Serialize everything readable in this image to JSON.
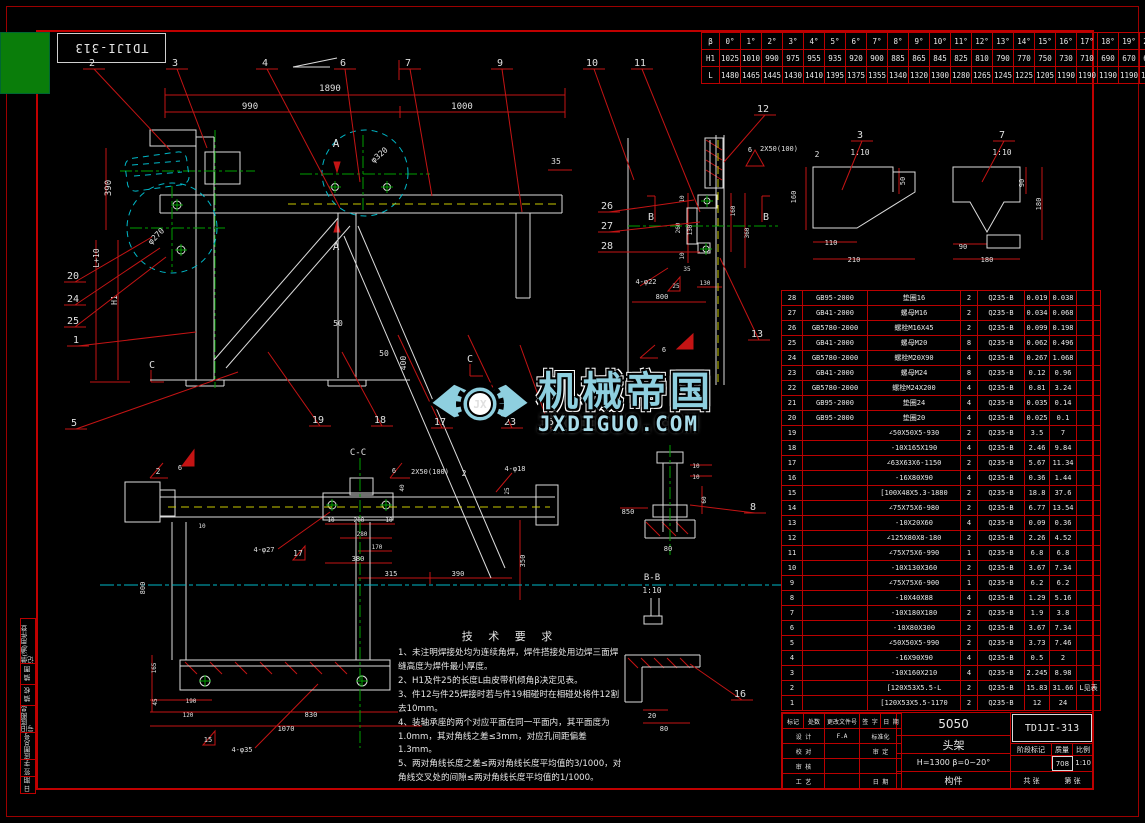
{
  "corner_drawing_no": "TD1JI-313",
  "angle_table": {
    "row_labels": [
      "β",
      "H1",
      "L"
    ],
    "rows": [
      [
        "0°",
        "1°",
        "2°",
        "3°",
        "4°",
        "5°",
        "6°",
        "7°",
        "8°",
        "9°",
        "10°",
        "11°",
        "12°",
        "13°",
        "14°",
        "15°",
        "16°",
        "17°",
        "18°",
        "19°",
        "20°"
      ],
      [
        "1025",
        "1010",
        "990",
        "975",
        "955",
        "935",
        "920",
        "900",
        "885",
        "865",
        "845",
        "825",
        "810",
        "790",
        "770",
        "750",
        "730",
        "710",
        "690",
        "670",
        "645"
      ],
      [
        "1480",
        "1465",
        "1445",
        "1430",
        "1410",
        "1395",
        "1375",
        "1355",
        "1340",
        "1320",
        "1300",
        "1280",
        "1265",
        "1245",
        "1225",
        "1205",
        "1190",
        "1190",
        "1190",
        "1190",
        "1190"
      ]
    ]
  },
  "parts_list": {
    "rows": [
      [
        "28",
        "GB95-2000",
        "垫圈16",
        "2",
        "Q235-B",
        "0.019",
        "0.038",
        ""
      ],
      [
        "27",
        "GB41-2000",
        "螺母M16",
        "2",
        "Q235-B",
        "0.034",
        "0.068",
        ""
      ],
      [
        "26",
        "GB5780-2000",
        "螺栓M16X45",
        "2",
        "Q235-B",
        "0.099",
        "0.198",
        ""
      ],
      [
        "25",
        "GB41-2000",
        "螺母M20",
        "8",
        "Q235-B",
        "0.062",
        "0.496",
        ""
      ],
      [
        "24",
        "GB5780-2000",
        "螺栓M20X90",
        "4",
        "Q235-B",
        "0.267",
        "1.068",
        ""
      ],
      [
        "23",
        "GB41-2000",
        "螺母M24",
        "8",
        "Q235-B",
        "0.12",
        "0.96",
        ""
      ],
      [
        "22",
        "GB5780-2000",
        "螺栓M24X200",
        "4",
        "Q235-B",
        "0.81",
        "3.24",
        ""
      ],
      [
        "21",
        "GB95-2000",
        "垫圈24",
        "4",
        "Q235-B",
        "0.035",
        "0.14",
        ""
      ],
      [
        "20",
        "GB95-2000",
        "垫圈20",
        "4",
        "Q235-B",
        "0.025",
        "0.1",
        ""
      ],
      [
        "19",
        "",
        "∠50X50X5-930",
        "2",
        "Q235-B",
        "3.5",
        "7",
        ""
      ],
      [
        "18",
        "",
        "-10X165X190",
        "4",
        "Q235-B",
        "2.46",
        "9.84",
        ""
      ],
      [
        "17",
        "",
        "∠63X63X6-1150",
        "2",
        "Q235-B",
        "5.67",
        "11.34",
        ""
      ],
      [
        "16",
        "",
        "-16X80X90",
        "4",
        "Q235-B",
        "0.36",
        "1.44",
        ""
      ],
      [
        "15",
        "",
        "[100X48X5.3-1880",
        "2",
        "Q235-B",
        "18.8",
        "37.6",
        ""
      ],
      [
        "14",
        "",
        "∠75X75X6-980",
        "2",
        "Q235-B",
        "6.77",
        "13.54",
        ""
      ],
      [
        "13",
        "",
        "-10X20X60",
        "4",
        "Q235-B",
        "0.09",
        "0.36",
        ""
      ],
      [
        "12",
        "",
        "∠125X80X8-180",
        "2",
        "Q235-B",
        "2.26",
        "4.52",
        ""
      ],
      [
        "11",
        "",
        "∠75X75X6-990",
        "1",
        "Q235-B",
        "6.8",
        "6.8",
        ""
      ],
      [
        "10",
        "",
        "-10X130X360",
        "2",
        "Q235-B",
        "3.67",
        "7.34",
        ""
      ],
      [
        "9",
        "",
        "∠75X75X6-900",
        "1",
        "Q235-B",
        "6.2",
        "6.2",
        ""
      ],
      [
        "8",
        "",
        "-10X40X88",
        "4",
        "Q235-B",
        "1.29",
        "5.16",
        ""
      ],
      [
        "7",
        "",
        "-10X180X180",
        "2",
        "Q235-B",
        "1.9",
        "3.8",
        ""
      ],
      [
        "6",
        "",
        "-10X80X300",
        "2",
        "Q235-B",
        "3.67",
        "7.34",
        ""
      ],
      [
        "5",
        "",
        "∠50X50X5-990",
        "2",
        "Q235-B",
        "3.73",
        "7.46",
        ""
      ],
      [
        "4",
        "",
        "-16X90X90",
        "4",
        "Q235-B",
        "0.5",
        "2",
        ""
      ],
      [
        "3",
        "",
        "-10X160X210",
        "4",
        "Q235-B",
        "2.245",
        "8.98",
        ""
      ],
      [
        "2",
        "",
        "[120X53X5.5-L",
        "2",
        "Q235-B",
        "15.83",
        "31.66",
        "L见表"
      ],
      [
        "1",
        "",
        "[120X53X5.5-1170",
        "2",
        "Q235-B",
        "12",
        "24",
        ""
      ]
    ]
  },
  "title_block": {
    "project": "5050",
    "name": "头架",
    "spec": "H=1300  β=0~20°",
    "type_label": "构件",
    "drawing_no": "TD1JI-313",
    "rev_header": [
      "标记",
      "处数",
      "更改文件号",
      "签 字",
      "日 期"
    ],
    "sign_rows": [
      [
        "设 计",
        "F.A",
        "标准化"
      ],
      [
        "校 对",
        "",
        "审 定"
      ],
      [
        "审 核",
        "",
        ""
      ],
      [
        "工 艺",
        "",
        "日 期"
      ]
    ],
    "stage_headers": [
      "阶段标记",
      "质量",
      "比例"
    ],
    "mass": "708",
    "scale": "1:10",
    "sheet_left": "共  张",
    "sheet_right": "第  张"
  },
  "border_fields": [
    "借(通)用件登记",
    "描 图",
    "描 校",
    "旧底图总号",
    "底图总号",
    "签 字",
    "日 期"
  ],
  "tech_req": {
    "title": "技 术 要 求",
    "lines": [
      "1、未注明焊接处均为连续角焊，焊件搭接处用边焊三面焊缝高度为焊件最小厚度。",
      "2、H1及件25的长度L由皮带机倾角β决定见表。",
      "3、件12与件25焊接时若与件19相碰时在相碰处将件12割去10mm。",
      "4、装轴承座的两个对应平面在同一平面内，其平面度为1.0mm，其对角线之差≤3mm，对应孔间距偏差1.3mm。",
      "5、两对角线长度之差≤两对角线长度平均值的3/1000，对角线交叉处的间隙≤两对角线长度平均值的1/1000。"
    ]
  },
  "watermark": {
    "brand": "机械帝国",
    "site": "JXDIGUO.COM",
    "monogram": "JX"
  },
  "drawing": {
    "labels": [
      {
        "t": "1890",
        "x": 330,
        "y": 91
      },
      {
        "t": "990",
        "x": 250,
        "y": 109
      },
      {
        "t": "1000",
        "x": 462,
        "y": 109
      },
      {
        "t": "35",
        "x": 556,
        "y": 164,
        "s": 8
      },
      {
        "t": "390",
        "x": 111,
        "y": 188,
        "r": -90
      },
      {
        "t": "L+10",
        "x": 99,
        "y": 258,
        "r": -90,
        "s": 8
      },
      {
        "t": "H1",
        "x": 117,
        "y": 300,
        "r": -90,
        "s": 8
      },
      {
        "t": "A",
        "x": 336,
        "y": 147,
        "s": 11
      },
      {
        "t": "A",
        "x": 336,
        "y": 250,
        "s": 11
      },
      {
        "t": "φ320",
        "x": 381,
        "y": 157,
        "r": -40,
        "s": 8
      },
      {
        "t": "φ270",
        "x": 158,
        "y": 238,
        "r": -45,
        "s": 8
      },
      {
        "t": "50",
        "x": 338,
        "y": 326,
        "s": 8
      },
      {
        "t": "50",
        "x": 384,
        "y": 356,
        "s": 8
      },
      {
        "t": "400",
        "x": 406,
        "y": 363,
        "r": -90,
        "s": 8
      },
      {
        "t": "C",
        "x": 152,
        "y": 368,
        "s": 10
      },
      {
        "t": "C",
        "x": 470,
        "y": 362,
        "s": 10
      },
      {
        "t": "B",
        "x": 651,
        "y": 220,
        "s": 10
      },
      {
        "t": "B",
        "x": 766,
        "y": 220,
        "s": 10
      },
      {
        "t": "2X50(100)",
        "x": 779,
        "y": 151,
        "s": 7
      },
      {
        "t": "6",
        "x": 750,
        "y": 152,
        "s": 7
      },
      {
        "t": "2",
        "x": 817,
        "y": 157,
        "s": 8
      },
      {
        "t": "10",
        "x": 684,
        "y": 199,
        "r": -90,
        "s": 6
      },
      {
        "t": "260",
        "x": 680,
        "y": 228,
        "r": -90,
        "s": 6
      },
      {
        "t": "130",
        "x": 692,
        "y": 230,
        "r": -90,
        "s": 6
      },
      {
        "t": "10",
        "x": 684,
        "y": 256,
        "r": -90,
        "s": 6
      },
      {
        "t": "160",
        "x": 735,
        "y": 211,
        "r": -90,
        "s": 6
      },
      {
        "t": "360",
        "x": 749,
        "y": 233,
        "r": -90,
        "s": 6
      },
      {
        "t": "35",
        "x": 687,
        "y": 271,
        "s": 6
      },
      {
        "t": "130",
        "x": 705,
        "y": 285,
        "s": 6
      },
      {
        "t": "25",
        "x": 676,
        "y": 288,
        "s": 6
      },
      {
        "t": "4-φ22",
        "x": 646,
        "y": 284,
        "s": 7
      },
      {
        "t": "800",
        "x": 662,
        "y": 299,
        "s": 7
      },
      {
        "t": "6",
        "x": 664,
        "y": 352,
        "s": 7
      },
      {
        "t": "10",
        "x": 696,
        "y": 468,
        "s": 6
      },
      {
        "t": "10",
        "x": 696,
        "y": 479,
        "s": 6
      },
      {
        "t": "60",
        "x": 706,
        "y": 500,
        "r": -90,
        "s": 6
      },
      {
        "t": "850",
        "x": 628,
        "y": 514,
        "s": 7
      },
      {
        "t": "80",
        "x": 668,
        "y": 551,
        "s": 7
      },
      {
        "t": "B-B",
        "x": 652,
        "y": 580,
        "s": 9
      },
      {
        "t": "1:10",
        "x": 652,
        "y": 593,
        "s": 8
      },
      {
        "t": "20",
        "x": 652,
        "y": 718,
        "s": 7
      },
      {
        "t": "80",
        "x": 664,
        "y": 731,
        "s": 7
      },
      {
        "t": "C-C",
        "x": 358,
        "y": 455,
        "s": 9
      },
      {
        "t": "2",
        "x": 158,
        "y": 474,
        "s": 8
      },
      {
        "t": "6",
        "x": 180,
        "y": 470,
        "s": 7
      },
      {
        "t": "6",
        "x": 394,
        "y": 473,
        "s": 7
      },
      {
        "t": "2X50(100)",
        "x": 430,
        "y": 474,
        "s": 7
      },
      {
        "t": "2",
        "x": 464,
        "y": 476,
        "s": 8
      },
      {
        "t": "40",
        "x": 404,
        "y": 488,
        "r": -90,
        "s": 6
      },
      {
        "t": "4-φ18",
        "x": 515,
        "y": 471,
        "s": 7
      },
      {
        "t": "25",
        "x": 509,
        "y": 491,
        "r": -90,
        "s": 6
      },
      {
        "t": "10",
        "x": 331,
        "y": 522,
        "s": 6
      },
      {
        "t": "200",
        "x": 359,
        "y": 522,
        "s": 6
      },
      {
        "t": "10",
        "x": 389,
        "y": 522,
        "s": 6
      },
      {
        "t": "280",
        "x": 362,
        "y": 536,
        "s": 6
      },
      {
        "t": "170",
        "x": 377,
        "y": 549,
        "s": 6
      },
      {
        "t": "380",
        "x": 358,
        "y": 561,
        "s": 7
      },
      {
        "t": "315",
        "x": 391,
        "y": 576,
        "s": 7
      },
      {
        "t": "390",
        "x": 458,
        "y": 576,
        "s": 7
      },
      {
        "t": "350",
        "x": 525,
        "y": 561,
        "r": -90,
        "s": 7
      },
      {
        "t": "4-φ27",
        "x": 264,
        "y": 552,
        "s": 7
      },
      {
        "t": "17",
        "x": 298,
        "y": 556,
        "s": 8
      },
      {
        "t": "10",
        "x": 202,
        "y": 528,
        "s": 6
      },
      {
        "t": "800",
        "x": 145,
        "y": 588,
        "r": -90,
        "s": 7
      },
      {
        "t": "165",
        "x": 156,
        "y": 668,
        "r": -90,
        "s": 6
      },
      {
        "t": "45",
        "x": 157,
        "y": 702,
        "r": -90,
        "s": 6
      },
      {
        "t": "190",
        "x": 191,
        "y": 703,
        "s": 6
      },
      {
        "t": "120",
        "x": 188,
        "y": 717,
        "s": 6
      },
      {
        "t": "830",
        "x": 311,
        "y": 717,
        "s": 7
      },
      {
        "t": "1070",
        "x": 286,
        "y": 731,
        "s": 7
      },
      {
        "t": "4-φ35",
        "x": 242,
        "y": 752,
        "s": 7
      },
      {
        "t": "15",
        "x": 208,
        "y": 742,
        "s": 7
      },
      {
        "t": "1:10",
        "x": 860,
        "y": 155,
        "s": 8
      },
      {
        "t": "1:10",
        "x": 1002,
        "y": 155,
        "s": 8
      },
      {
        "t": "160",
        "x": 796,
        "y": 197,
        "r": -90,
        "s": 7
      },
      {
        "t": "50",
        "x": 905,
        "y": 181,
        "r": -90,
        "s": 7
      },
      {
        "t": "110",
        "x": 831,
        "y": 245,
        "s": 7
      },
      {
        "t": "210",
        "x": 854,
        "y": 262,
        "s": 7
      },
      {
        "t": "90",
        "x": 1024,
        "y": 183,
        "r": -90,
        "s": 7
      },
      {
        "t": "180",
        "x": 1041,
        "y": 204,
        "r": -90,
        "s": 7
      },
      {
        "t": "90",
        "x": 963,
        "y": 249,
        "s": 7
      },
      {
        "t": "180",
        "x": 987,
        "y": 262,
        "s": 7
      }
    ],
    "balloons": [
      {
        "t": "2",
        "x": 92,
        "y": 66,
        "ex": 170,
        "ey": 150
      },
      {
        "t": "3",
        "x": 175,
        "y": 66,
        "ex": 207,
        "ey": 148
      },
      {
        "t": "4",
        "x": 265,
        "y": 66,
        "ex": 340,
        "ey": 208
      },
      {
        "t": "6",
        "x": 343,
        "y": 66,
        "ex": 360,
        "ey": 182
      },
      {
        "t": "7",
        "x": 408,
        "y": 66,
        "ex": 432,
        "ey": 196
      },
      {
        "t": "9",
        "x": 500,
        "y": 66,
        "ex": 522,
        "ey": 212
      },
      {
        "t": "10",
        "x": 592,
        "y": 66,
        "ex": 634,
        "ey": 180
      },
      {
        "t": "11",
        "x": 640,
        "y": 66,
        "ex": 700,
        "ey": 212
      },
      {
        "t": "12",
        "x": 763,
        "y": 112,
        "ex": 724,
        "ey": 162
      },
      {
        "t": "13",
        "x": 757,
        "y": 337,
        "ex": 720,
        "ey": 258
      },
      {
        "t": "20",
        "x": 73,
        "y": 279,
        "ex": 152,
        "ey": 237
      },
      {
        "t": "24",
        "x": 73,
        "y": 302,
        "ex": 160,
        "ey": 248
      },
      {
        "t": "25",
        "x": 73,
        "y": 324,
        "ex": 166,
        "ey": 257
      },
      {
        "t": "1",
        "x": 76,
        "y": 343,
        "ex": 196,
        "ey": 332
      },
      {
        "t": "5",
        "x": 74,
        "y": 426,
        "ex": 238,
        "ey": 372
      },
      {
        "t": "19",
        "x": 318,
        "y": 423,
        "ex": 268,
        "ey": 352
      },
      {
        "t": "18",
        "x": 380,
        "y": 423,
        "ex": 342,
        "ey": 352
      },
      {
        "t": "17",
        "x": 440,
        "y": 425,
        "ex": 398,
        "ey": 335
      },
      {
        "t": "23",
        "x": 510,
        "y": 425,
        "ex": 468,
        "ey": 335
      },
      {
        "t": "15",
        "x": 548,
        "y": 425,
        "ex": 520,
        "ey": 345
      },
      {
        "t": "8",
        "x": 753,
        "y": 510,
        "ex": 690,
        "ey": 505
      },
      {
        "t": "16",
        "x": 740,
        "y": 697,
        "ex": 690,
        "ey": 664
      },
      {
        "t": "26",
        "x": 607,
        "y": 209,
        "ex": 694,
        "ey": 200
      },
      {
        "t": "27",
        "x": 607,
        "y": 229,
        "ex": 700,
        "ey": 222
      },
      {
        "t": "28",
        "x": 607,
        "y": 249,
        "ex": 700,
        "ey": 252
      },
      {
        "t": "3",
        "x": 860,
        "y": 138,
        "ex": 842,
        "ey": 190
      },
      {
        "t": "7",
        "x": 1002,
        "y": 138,
        "ex": 982,
        "ey": 182
      }
    ]
  }
}
